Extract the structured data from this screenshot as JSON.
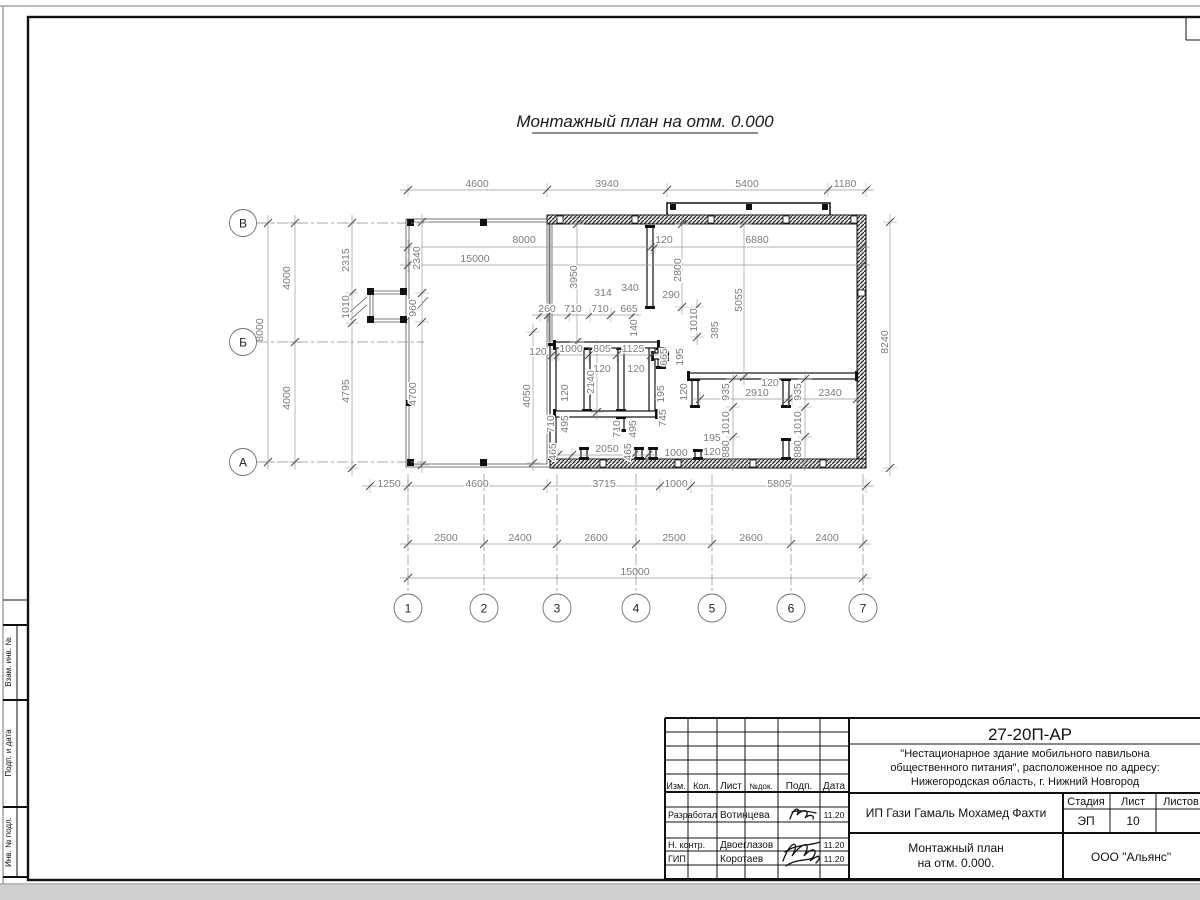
{
  "sheet": {
    "title": "Монтажный план на отм. 0.000",
    "margin_labels": [
      "Взам. инв. №",
      "Подп. и дата",
      "Инв. № подл."
    ]
  },
  "plan": {
    "axes_rows": [
      {
        "label": "В",
        "y": 223
      },
      {
        "label": "Б",
        "y": 342
      },
      {
        "label": "А",
        "y": 462
      }
    ],
    "axes_cols": [
      {
        "label": "1",
        "x": 408
      },
      {
        "label": "2",
        "x": 484
      },
      {
        "label": "3",
        "x": 557
      },
      {
        "label": "4",
        "x": 636
      },
      {
        "label": "5",
        "x": 712
      },
      {
        "label": "6",
        "x": 791
      },
      {
        "label": "7",
        "x": 863
      }
    ],
    "dims": [
      {
        "t": "4600",
        "x": 477,
        "y": 187
      },
      {
        "t": "3940",
        "x": 607,
        "y": 187
      },
      {
        "t": "5400",
        "x": 747,
        "y": 187
      },
      {
        "t": "1180",
        "x": 845,
        "y": 187
      },
      {
        "t": "8000",
        "x": 524,
        "y": 243
      },
      {
        "t": "120",
        "x": 664,
        "y": 243
      },
      {
        "t": "6880",
        "x": 757,
        "y": 243
      },
      {
        "t": "15000",
        "x": 475,
        "y": 262
      },
      {
        "t": "2340",
        "x": 420,
        "y": 258,
        "r": 90
      },
      {
        "t": "960",
        "x": 416,
        "y": 308,
        "r": 90
      },
      {
        "t": "4700",
        "x": 416,
        "y": 394,
        "r": 90
      },
      {
        "t": "2315",
        "x": 349,
        "y": 260,
        "r": 90
      },
      {
        "t": "1010",
        "x": 349,
        "y": 307,
        "r": 90
      },
      {
        "t": "4795",
        "x": 349,
        "y": 391,
        "r": 90
      },
      {
        "t": "4000",
        "x": 290,
        "y": 278,
        "r": 90
      },
      {
        "t": "8000",
        "x": 263,
        "y": 330,
        "r": 90
      },
      {
        "t": "4000",
        "x": 290,
        "y": 398,
        "r": 90
      },
      {
        "t": "8240",
        "x": 888,
        "y": 342,
        "r": 90
      },
      {
        "t": "3950",
        "x": 577,
        "y": 277,
        "r": 90
      },
      {
        "t": "2800",
        "x": 681,
        "y": 270,
        "r": 90
      },
      {
        "t": "5055",
        "x": 742,
        "y": 300,
        "r": 90
      },
      {
        "t": "314",
        "x": 603,
        "y": 296
      },
      {
        "t": "340",
        "x": 630,
        "y": 291
      },
      {
        "t": "290",
        "x": 671,
        "y": 298
      },
      {
        "t": "260",
        "x": 547,
        "y": 312
      },
      {
        "t": "710",
        "x": 573,
        "y": 312
      },
      {
        "t": "710",
        "x": 600,
        "y": 312
      },
      {
        "t": "665",
        "x": 629,
        "y": 312
      },
      {
        "t": "140",
        "x": 637,
        "y": 328,
        "r": 90
      },
      {
        "t": "1010",
        "x": 697,
        "y": 320,
        "r": 90
      },
      {
        "t": "385",
        "x": 718,
        "y": 330,
        "r": 90
      },
      {
        "t": "120",
        "x": 538,
        "y": 355
      },
      {
        "t": "1000",
        "x": 571,
        "y": 352
      },
      {
        "t": "805",
        "x": 602,
        "y": 352
      },
      {
        "t": "1125",
        "x": 633,
        "y": 352
      },
      {
        "t": "120",
        "x": 602,
        "y": 372
      },
      {
        "t": "120",
        "x": 636,
        "y": 372
      },
      {
        "t": "665",
        "x": 667,
        "y": 357,
        "r": 90
      },
      {
        "t": "195",
        "x": 683,
        "y": 357,
        "r": 90
      },
      {
        "t": "2140",
        "x": 594,
        "y": 382,
        "r": 90
      },
      {
        "t": "120",
        "x": 568,
        "y": 393,
        "r": 90
      },
      {
        "t": "4050",
        "x": 530,
        "y": 396,
        "r": 90
      },
      {
        "t": "120",
        "x": 687,
        "y": 392,
        "r": 90
      },
      {
        "t": "195",
        "x": 664,
        "y": 394,
        "r": 90
      },
      {
        "t": "745",
        "x": 666,
        "y": 418,
        "r": 90
      },
      {
        "t": "120",
        "x": 770,
        "y": 386
      },
      {
        "t": "2910",
        "x": 757,
        "y": 396
      },
      {
        "t": "2340",
        "x": 830,
        "y": 396
      },
      {
        "t": "935",
        "x": 729,
        "y": 392,
        "r": 90
      },
      {
        "t": "935",
        "x": 801,
        "y": 392,
        "r": 90
      },
      {
        "t": "1010",
        "x": 729,
        "y": 423,
        "r": 90
      },
      {
        "t": "1010",
        "x": 801,
        "y": 423,
        "r": 90
      },
      {
        "t": "880",
        "x": 729,
        "y": 449,
        "r": 90
      },
      {
        "t": "880",
        "x": 801,
        "y": 449,
        "r": 90
      },
      {
        "t": "710",
        "x": 554,
        "y": 424,
        "r": 90
      },
      {
        "t": "495",
        "x": 568,
        "y": 424,
        "r": 90
      },
      {
        "t": "710",
        "x": 620,
        "y": 429,
        "r": 90
      },
      {
        "t": "495",
        "x": 636,
        "y": 429,
        "r": 90
      },
      {
        "t": "465",
        "x": 556,
        "y": 452,
        "r": 90
      },
      {
        "t": "2050",
        "x": 607,
        "y": 452
      },
      {
        "t": "465",
        "x": 631,
        "y": 452,
        "r": 90
      },
      {
        "t": "195",
        "x": 712,
        "y": 441
      },
      {
        "t": "1000",
        "x": 676,
        "y": 456
      },
      {
        "t": "120",
        "x": 712,
        "y": 455
      },
      {
        "t": "1250",
        "x": 389,
        "y": 487
      },
      {
        "t": "4600",
        "x": 477,
        "y": 487
      },
      {
        "t": "3715",
        "x": 604,
        "y": 487
      },
      {
        "t": "1000",
        "x": 676,
        "y": 487
      },
      {
        "t": "5805",
        "x": 779,
        "y": 487
      },
      {
        "t": "2500",
        "x": 446,
        "y": 541
      },
      {
        "t": "2400",
        "x": 520,
        "y": 541
      },
      {
        "t": "2600",
        "x": 596,
        "y": 541
      },
      {
        "t": "2500",
        "x": 674,
        "y": 541
      },
      {
        "t": "2600",
        "x": 751,
        "y": 541
      },
      {
        "t": "2400",
        "x": 827,
        "y": 541
      },
      {
        "t": "15000",
        "x": 635,
        "y": 575
      }
    ]
  },
  "titleblock": {
    "doc_number": "27-20П-АР",
    "description_lines": [
      "\"Нестационарное здание мобильного павильона",
      "общественного питания\", расположенное по адресу:",
      "Нижегородская область, г. Нижний Новгород"
    ],
    "client": "ИП Гази Гамаль Мохамед Фахти",
    "stage_label": "Стадия",
    "sheet_label": "Лист",
    "sheets_label": "Листов",
    "stage": "ЭП",
    "sheet_num": "10",
    "drawing_name_lines": [
      "Монтажный план",
      "на отм. 0.000."
    ],
    "company": "ООО \"Альянс\"",
    "header_cols": [
      "Изм.",
      "Кол.",
      "Лист",
      "№док.",
      "Подп.",
      "Дата"
    ],
    "sign_rows": [
      {
        "role": "Разработал",
        "name": "Вотинцева",
        "date": "11.20"
      },
      {
        "role": "Н. контр.",
        "name": "Двоеглазов",
        "date": "11.20"
      },
      {
        "role": "ГИП",
        "name": "Коротаев",
        "date": "11.20"
      }
    ]
  }
}
